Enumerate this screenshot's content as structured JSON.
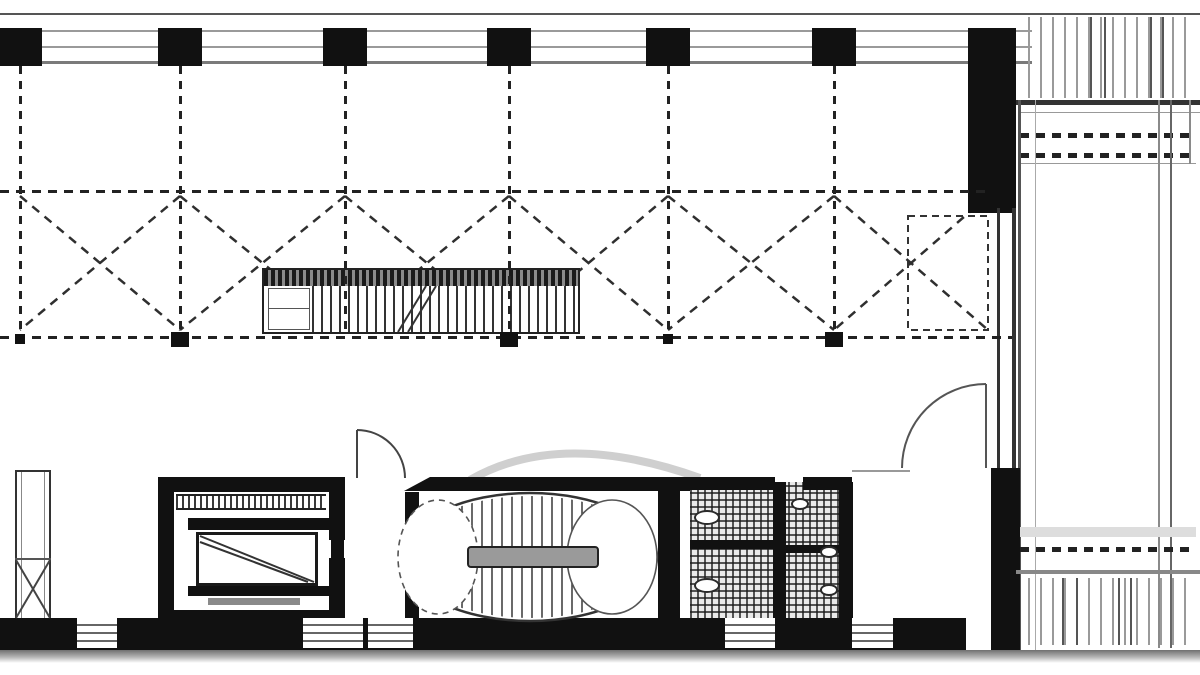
{
  "document": {
    "kind": "architectural floor plan",
    "content_text": ""
  },
  "palette": {
    "ink": "#111111",
    "line_dark": "#333333",
    "line_mid": "#666666",
    "line_light": "#9a9a9a",
    "background": "#ffffff",
    "landing_gray": "#9a9a9a",
    "fade_gray": "#6f6f6f",
    "deck_gray": "#9a9a9a"
  },
  "grid": {
    "column_centers_x": [
      20,
      180,
      345,
      509,
      668,
      834
    ],
    "column_y": 28,
    "column_w": 44,
    "column_h": 38,
    "dash_vertical_top": 66,
    "dash_vertical_bottom": 336,
    "bays": [
      [
        20,
        180
      ],
      [
        180,
        345
      ],
      [
        345,
        509
      ],
      [
        509,
        668
      ],
      [
        668,
        834
      ],
      [
        834,
        988
      ]
    ],
    "brace_top": 196,
    "brace_bottom": 330,
    "node_bold_x": [
      180,
      509,
      834
    ],
    "node_small_x": [
      20,
      668
    ],
    "node_y": 332
  },
  "stair_oval": {
    "cx": 530,
    "cy": 557,
    "rx": 127,
    "ry": 64,
    "tread_x0": 452,
    "tread_x1": 606,
    "tread_step": 10,
    "clip_rx": 124,
    "clip_ry": 61
  },
  "terrace": {
    "deck_dark_top_x": [
      1090,
      1104,
      1150,
      1162
    ],
    "deck_dark_bottom_x": [
      1062,
      1076,
      1118,
      1130
    ]
  },
  "bottom_wall": {
    "y": 618,
    "h": 32,
    "x_end": 966,
    "windows": [
      [
        77,
        117
      ],
      [
        303,
        363
      ],
      [
        368,
        413
      ],
      [
        725,
        775
      ],
      [
        852,
        893
      ]
    ],
    "glazing_lines_y": [
      624,
      632,
      640
    ]
  },
  "rects": [
    {
      "cls": "ln",
      "x": 0,
      "y": 13,
      "w": 1200,
      "h": 2,
      "c": "#555",
      "name": "north-wall-outer-line"
    },
    {
      "cls": "ln",
      "x": 0,
      "y": 30,
      "w": 1032,
      "h": 2,
      "c": "#9a9a9a",
      "name": "north-wall-glazing-line"
    },
    {
      "cls": "ln",
      "x": 0,
      "y": 46,
      "w": 1032,
      "h": 2,
      "c": "#9a9a9a",
      "name": "north-wall-glazing-line"
    },
    {
      "cls": "ln",
      "x": 0,
      "y": 61,
      "w": 1032,
      "h": 3,
      "c": "#7a7a7a",
      "name": "north-wall-inner-line"
    },
    {
      "cls": "w",
      "x": 968,
      "y": 28,
      "w": 48,
      "h": 185,
      "name": "northeast-corner-wall"
    },
    {
      "cls": "deck",
      "x": 1028,
      "y": 17,
      "w": 168,
      "h": 81,
      "name": "terrace-deck-top"
    },
    {
      "cls": "ln",
      "x": 1016,
      "y": 100,
      "w": 184,
      "h": 5,
      "c": "#333",
      "name": "terrace-edge-heavy-line"
    },
    {
      "cls": "ln",
      "x": 1020,
      "y": 112,
      "w": 180,
      "h": 1,
      "c": "#999",
      "name": "terrace-line"
    },
    {
      "cls": "dash-h",
      "x": 1020,
      "y": 133,
      "w": 176,
      "h": 5,
      "name": "terrace-dashed-row"
    },
    {
      "cls": "dash-h",
      "x": 1020,
      "y": 153,
      "w": 176,
      "h": 5,
      "name": "terrace-dashed-row"
    },
    {
      "cls": "ln",
      "x": 1020,
      "y": 163,
      "w": 176,
      "h": 1,
      "c": "#999",
      "name": "terrace-line"
    },
    {
      "cls": "ln",
      "x": 1018,
      "y": 100,
      "w": 3,
      "h": 552,
      "c": "#555",
      "name": "east-facade-line"
    },
    {
      "cls": "ln",
      "x": 1035,
      "y": 100,
      "w": 1,
      "h": 552,
      "c": "#aaa",
      "name": "east-facade-line"
    },
    {
      "cls": "ln",
      "x": 1158,
      "y": 100,
      "w": 2,
      "h": 548,
      "c": "#8a8a8a",
      "name": "terrace-border-line"
    },
    {
      "cls": "ln",
      "x": 1170,
      "y": 100,
      "w": 2,
      "h": 548,
      "c": "#666",
      "name": "terrace-border-line"
    },
    {
      "cls": "ln",
      "x": 1189,
      "y": 100,
      "w": 2,
      "h": 64,
      "c": "#8a8a8a",
      "name": "terrace-border-line"
    },
    {
      "cls": "ln",
      "x": 997,
      "y": 208,
      "w": 3,
      "h": 264,
      "c": "#333",
      "name": "east-wall-line"
    },
    {
      "cls": "ln",
      "x": 1012,
      "y": 208,
      "w": 4,
      "h": 264,
      "c": "#333",
      "name": "east-wall-line"
    },
    {
      "cls": "w",
      "x": 991,
      "y": 468,
      "w": 29,
      "h": 182,
      "name": "southeast-wall"
    },
    {
      "cls": "ln",
      "x": 1020,
      "y": 527,
      "w": 176,
      "h": 10,
      "c": "#ddd",
      "name": "terrace-light-band"
    },
    {
      "cls": "dash-h",
      "x": 1020,
      "y": 547,
      "w": 176,
      "h": 5,
      "name": "terrace-dashed-row"
    },
    {
      "cls": "ln",
      "x": 1016,
      "y": 570,
      "w": 184,
      "h": 4,
      "c": "#888",
      "name": "terrace-edge-line"
    },
    {
      "cls": "deck",
      "x": 1028,
      "y": 578,
      "w": 168,
      "h": 67,
      "name": "terrace-deck-bottom"
    },
    {
      "cls": "dash-h",
      "x": 0,
      "y": 190,
      "w": 988,
      "h": 3,
      "name": "structural-gridline-horizontal"
    },
    {
      "cls": "dash-h",
      "x": 0,
      "y": 336,
      "w": 1012,
      "h": 3,
      "name": "structural-gridline-horizontal"
    },
    {
      "cls": "shaft",
      "x": 15,
      "y": 470,
      "w": 36,
      "h": 150,
      "name": "duct-shaft"
    },
    {
      "cls": "ln",
      "x": 21,
      "y": 472,
      "w": 1,
      "h": 146,
      "c": "#888",
      "name": "duct-shaft-inner-line"
    },
    {
      "cls": "ln",
      "x": 44,
      "y": 472,
      "w": 1,
      "h": 146,
      "c": "#888",
      "name": "duct-shaft-inner-line"
    },
    {
      "cls": "ln",
      "x": 15,
      "y": 558,
      "w": 36,
      "h": 2,
      "c": "#555",
      "name": "duct-shaft-divider"
    },
    {
      "cls": "w",
      "x": 158,
      "y": 477,
      "w": 187,
      "h": 15,
      "name": "elevator-shaft-north-wall"
    },
    {
      "cls": "w",
      "x": 158,
      "y": 477,
      "w": 16,
      "h": 151,
      "name": "elevator-shaft-west-wall"
    },
    {
      "cls": "w",
      "x": 329,
      "y": 492,
      "w": 16,
      "h": 48,
      "name": "elevator-shaft-east-wall-upper"
    },
    {
      "cls": "w",
      "x": 329,
      "y": 558,
      "w": 16,
      "h": 72,
      "name": "elevator-shaft-east-wall-lower"
    },
    {
      "cls": "sill",
      "x": 176,
      "y": 494,
      "w": 150,
      "h": 16,
      "name": "elevator-door-sill"
    },
    {
      "cls": "w",
      "x": 188,
      "y": 518,
      "w": 142,
      "h": 12,
      "name": "elevator-inner-wall"
    },
    {
      "cls": "cab",
      "x": 196,
      "y": 532,
      "w": 122,
      "h": 54,
      "name": "elevator-cab"
    },
    {
      "cls": "w",
      "x": 188,
      "y": 586,
      "w": 142,
      "h": 10,
      "name": "elevator-inner-wall"
    },
    {
      "cls": "ln",
      "x": 208,
      "y": 598,
      "w": 92,
      "h": 7,
      "c": "#8a8a8a",
      "name": "elevator-counterweight"
    },
    {
      "cls": "w",
      "x": 158,
      "y": 610,
      "w": 187,
      "h": 22,
      "name": "elevator-shaft-south-wall"
    },
    {
      "cls": "w",
      "x": 330,
      "y": 477,
      "w": 15,
      "h": 15,
      "name": "vestibule-wall-stub"
    },
    {
      "cls": "w",
      "x": 331,
      "y": 527,
      "w": 13,
      "h": 63,
      "name": "vestibule-west-wall"
    },
    {
      "cls": "w",
      "x": 404,
      "y": 477,
      "w": 296,
      "h": 14,
      "name": "stair-room-north-wall",
      "clip": "poly"
    },
    {
      "cls": "w",
      "x": 405,
      "y": 492,
      "w": 14,
      "h": 126,
      "name": "stair-room-west-wall"
    },
    {
      "cls": "w",
      "x": 658,
      "y": 490,
      "w": 22,
      "h": 140,
      "name": "stair-room-east-wall"
    },
    {
      "cls": "xhatch",
      "x": 690,
      "y": 482,
      "w": 152,
      "h": 138,
      "name": "restroom-fixture-block"
    },
    {
      "cls": "w",
      "x": 773,
      "y": 482,
      "w": 13,
      "h": 140,
      "name": "restroom-divider-wall"
    },
    {
      "cls": "w",
      "x": 690,
      "y": 540,
      "w": 85,
      "h": 9,
      "name": "restroom-partition"
    },
    {
      "cls": "w",
      "x": 786,
      "y": 545,
      "w": 56,
      "h": 8,
      "name": "restroom-partition"
    },
    {
      "cls": "w",
      "x": 839,
      "y": 482,
      "w": 14,
      "h": 146,
      "name": "restroom-east-wall"
    },
    {
      "cls": "w",
      "x": 656,
      "y": 477,
      "w": 119,
      "h": 13,
      "name": "restroom-north-wall"
    },
    {
      "cls": "w",
      "x": 803,
      "y": 477,
      "w": 49,
      "h": 13,
      "name": "restroom-north-wall"
    },
    {
      "cls": "fix",
      "x": 694,
      "y": 510,
      "w": 26,
      "h": 15,
      "name": "toilet-fixture"
    },
    {
      "cls": "fix",
      "x": 694,
      "y": 578,
      "w": 26,
      "h": 15,
      "name": "toilet-fixture"
    },
    {
      "cls": "fix",
      "x": 791,
      "y": 498,
      "w": 18,
      "h": 12,
      "name": "sink-fixture"
    },
    {
      "cls": "fix",
      "x": 820,
      "y": 546,
      "w": 18,
      "h": 12,
      "name": "sink-fixture"
    },
    {
      "cls": "fix",
      "x": 820,
      "y": 584,
      "w": 18,
      "h": 12,
      "name": "sink-fixture"
    },
    {
      "cls": "ln",
      "x": 852,
      "y": 470,
      "w": 58,
      "h": 2,
      "c": "#999",
      "name": "door-opening-line"
    }
  ],
  "svg_under": [
    {
      "t": "rect",
      "x": 908,
      "y": 216,
      "w": 80,
      "h": 114,
      "s": "#333",
      "sw": 2,
      "da": "7 5",
      "name": "dashed-partition-outline"
    },
    {
      "t": "path",
      "d": "M470,480 Q560,428 700,478",
      "s": "#cfcfcf",
      "sw": 8,
      "name": "scan-smudge-arc"
    }
  ],
  "svg_over": [
    {
      "t": "line",
      "x1": 357,
      "y1": 430,
      "x2": 357,
      "y2": 478,
      "s": "#444",
      "sw": 2,
      "name": "vestibule-door-leaf"
    },
    {
      "t": "path",
      "d": "M357,430 A48,48 0 0 1 405,478",
      "s": "#444",
      "sw": 2,
      "name": "vestibule-door-swing-arc"
    },
    {
      "t": "line",
      "x1": 986,
      "y1": 384,
      "x2": 986,
      "y2": 468,
      "s": "#555",
      "sw": 2,
      "name": "east-room-door-leaf"
    },
    {
      "t": "path",
      "d": "M986,384 A84,84 0 0 0 902,468",
      "s": "#555",
      "sw": 2,
      "name": "east-room-door-swing-arc"
    },
    {
      "t": "line",
      "x1": 200,
      "y1": 536,
      "x2": 314,
      "y2": 582,
      "s": "#333",
      "sw": 2,
      "name": "elevator-cab-diagonal"
    },
    {
      "t": "line",
      "x1": 200,
      "y1": 542,
      "x2": 308,
      "y2": 582,
      "s": "#333",
      "sw": 2,
      "name": "elevator-cab-diagonal"
    },
    {
      "t": "line",
      "x1": 16,
      "y1": 560,
      "x2": 50,
      "y2": 618,
      "s": "#444",
      "sw": 2,
      "name": "duct-shaft-cross"
    },
    {
      "t": "line",
      "x1": 50,
      "y1": 560,
      "x2": 16,
      "y2": 618,
      "s": "#444",
      "sw": 2,
      "name": "duct-shaft-cross"
    },
    {
      "t": "line",
      "x1": 398,
      "y1": 332,
      "x2": 426,
      "y2": 286,
      "s": "#333",
      "sw": 2,
      "name": "stair-break-line"
    },
    {
      "t": "line",
      "x1": 408,
      "y1": 332,
      "x2": 436,
      "y2": 286,
      "s": "#333",
      "sw": 2,
      "name": "stair-break-line"
    }
  ]
}
